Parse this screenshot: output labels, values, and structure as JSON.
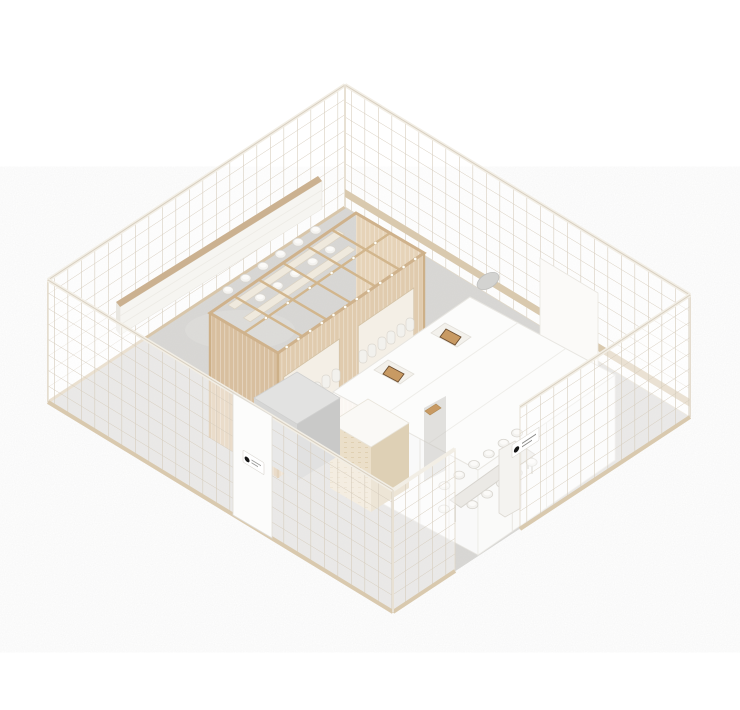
{
  "scene": {
    "title": "isometric-cafe-interior-rendering",
    "background": "#ffffff",
    "floor": {
      "material": "concrete",
      "color": "#d9d8d5"
    },
    "walls": {
      "style": "white-lattice-grid",
      "count": 4,
      "entrance_gap": "front-right-wall",
      "door_panel": "front-left-wall"
    },
    "signs": {
      "front_left": {
        "logo": "●"
      },
      "front_right": {
        "logo": "●"
      }
    },
    "objects": {
      "wood_pergola": {
        "bays": 6,
        "slat_screens": 3,
        "window_openings": 2,
        "hanging_lights": 18,
        "bar_seats": 12
      },
      "wall_credenza": {
        "seams": 2
      },
      "white_partition": {
        "roof_hoods": 2,
        "mullioned_walls": 2
      },
      "dining_table": {
        "seats": 12
      },
      "service_counter": {
        "finish": "stone"
      },
      "utility_box": {
        "finish": "gray"
      },
      "ac_unit": {
        "count": 1
      },
      "pergola_table_chairs": 11
    }
  },
  "palette": {
    "background": "#ffffff",
    "floor": "#d9d8d5",
    "floor_shade": "#cfceca",
    "floor_light": "#e3e2df",
    "lattice_line": "#d6ccbc",
    "wall_cap": "#f2eee5",
    "base_trim": "#d9c9ae",
    "wood_beam": "#d2b68d",
    "wood_slat_light": "#e6d3b8",
    "wood_slat_mid": "#e0cbae",
    "wood_slat_dark": "#d8bf9f",
    "window_opening": "#f4efe6",
    "credenza_white": "#f6f5f1",
    "credenza_top": "#cbb190",
    "partition_white": "#fcfcfb",
    "mullion": "#e9e7e2",
    "hood_wood": "#c89a63",
    "hood_dark": "#6b4c2e",
    "gray_box_top": "#e2e2e1",
    "gray_box_left": "#d6d6d5",
    "gray_box_right": "#c9c9c8",
    "counter_left": "#ebdfc9",
    "counter_right": "#ded0b5",
    "counter_top": "#faf9f6",
    "table_top": "#ebe9e5",
    "chair": "#f3f2ef",
    "ac_unit": "#d3d3d1",
    "sign_bg": "#ffffff",
    "sign_logo": "#161616",
    "corridor_shade": "#c6c4bf"
  }
}
